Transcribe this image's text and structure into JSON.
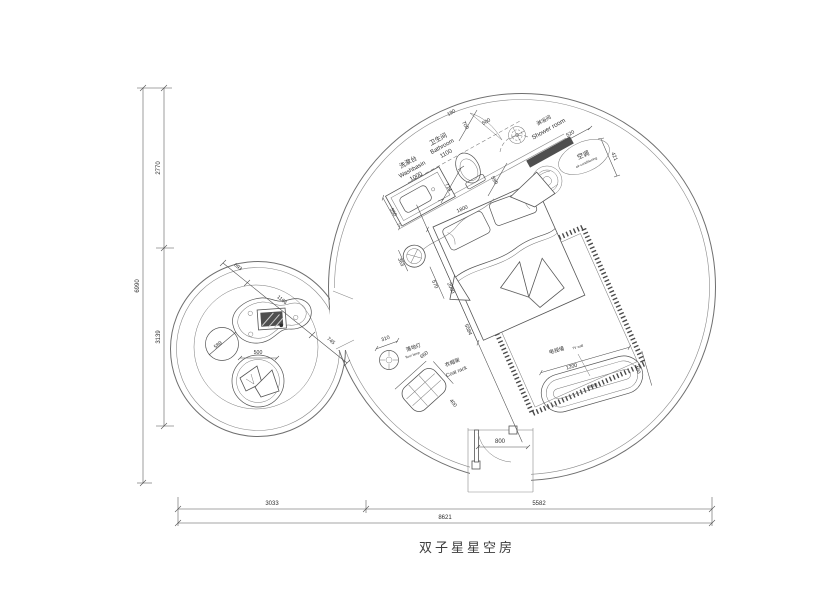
{
  "title": "双子星星空房",
  "labels": {
    "washbasin_cn": "洗漱台",
    "washbasin_en": "Washbasin",
    "bathroom_cn": "卫生间",
    "bathroom_en": "Bathroom",
    "shower_cn": "淋浴间",
    "shower_en": "Shower room",
    "ac_cn": "空调",
    "ac_en": "air-conditioning",
    "lamp_cn": "落地灯",
    "lamp_en": "floor lamp",
    "coat_cn": "衣帽架",
    "coat_en": "Coat rack",
    "tv_wall_cn": "电视墙",
    "tv_wall_en": "TV wall",
    "tv_cabinet_cn": "电视柜"
  },
  "dims": {
    "overall_width": "8621",
    "width_left": "3033",
    "width_right": "5582",
    "overall_height": "6990",
    "height_top": "2770",
    "height_bottom": "3139",
    "counter_width": "1000",
    "counter_depth": "550",
    "bathroom_width": "1100",
    "wall_190": "190",
    "door_700": "700",
    "door_500": "500",
    "dim_714": "714",
    "dim_590": "590",
    "bed_width": "1800",
    "bed_length": "2000",
    "diag_5584": "5584",
    "stool_363": "363",
    "stool_570": "570",
    "ac_520": "520",
    "ac_421": "421",
    "lamp_310": "310",
    "coat_660": "660",
    "coat_400": "400",
    "tv_1200": "1200",
    "tv_400": "400",
    "door_800": "800",
    "desk_693": "693",
    "desk_1166": "1166",
    "desk_745": "745",
    "pouf_589": "589",
    "chair_500": "500"
  }
}
